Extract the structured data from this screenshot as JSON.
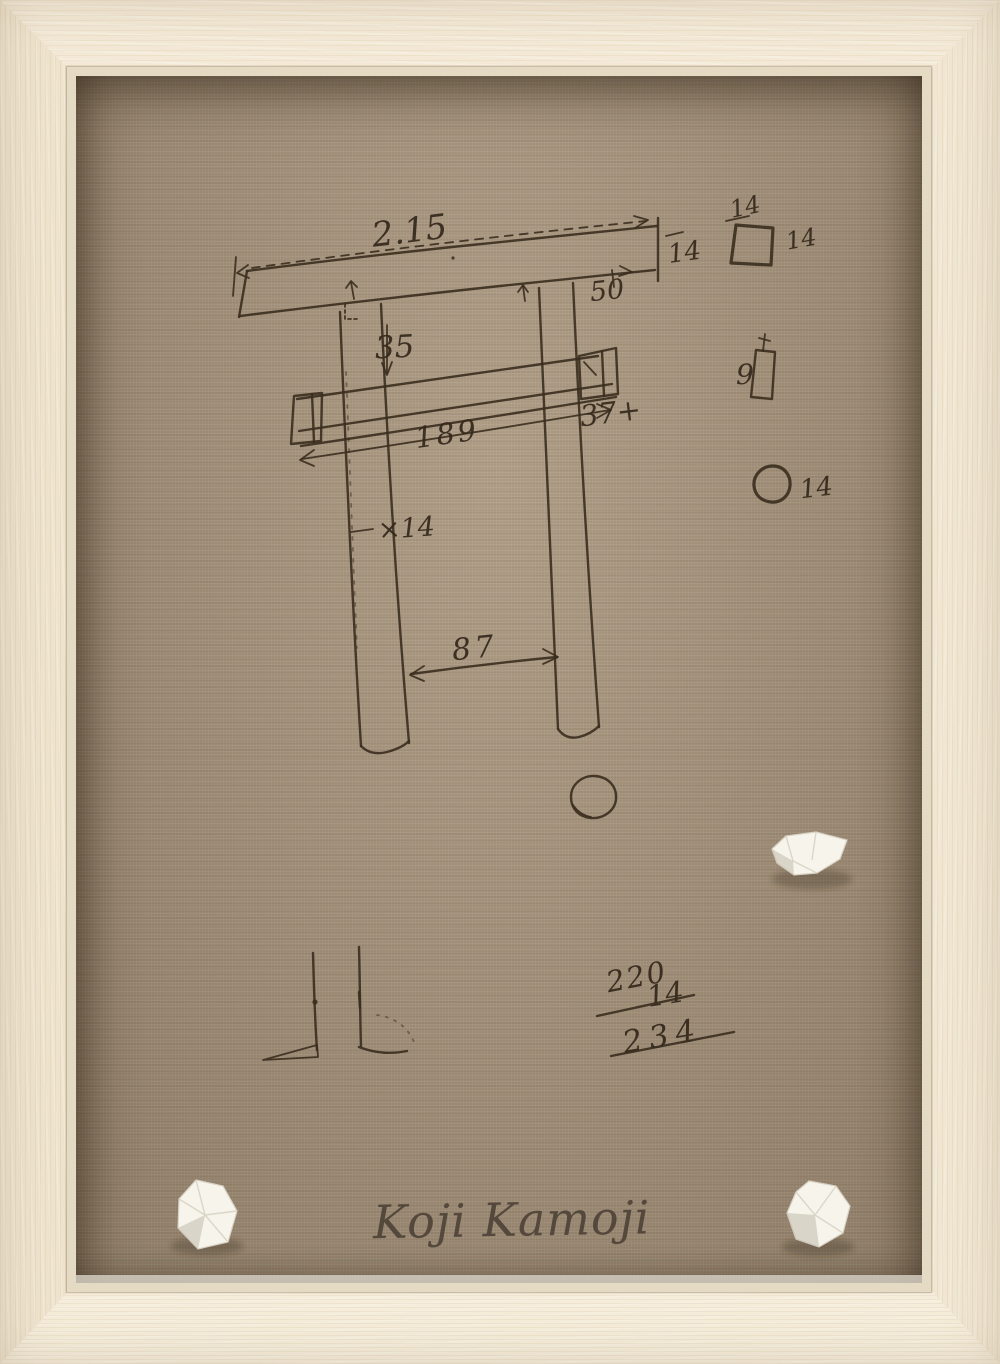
{
  "artwork": {
    "signature": "Koji Kamoji",
    "colors": {
      "frame": "#f1e7d4",
      "canvas_linen": "#a39078",
      "ink": "#3a2d1e",
      "stone": "#f7f4ec"
    },
    "sketch": {
      "dims": {
        "kasagi_length": "2.15",
        "kasagi_end": "14",
        "overhang": "50",
        "drop": "35",
        "nuki_length": "189",
        "nuki_end": "37+",
        "post_width": "×14",
        "post_gap": "87"
      },
      "details": {
        "square_top": "14",
        "square_side": "14",
        "bar": "9",
        "circle": "14"
      },
      "calc": {
        "addend1": "220",
        "addend2": "14",
        "total": "234"
      }
    }
  }
}
